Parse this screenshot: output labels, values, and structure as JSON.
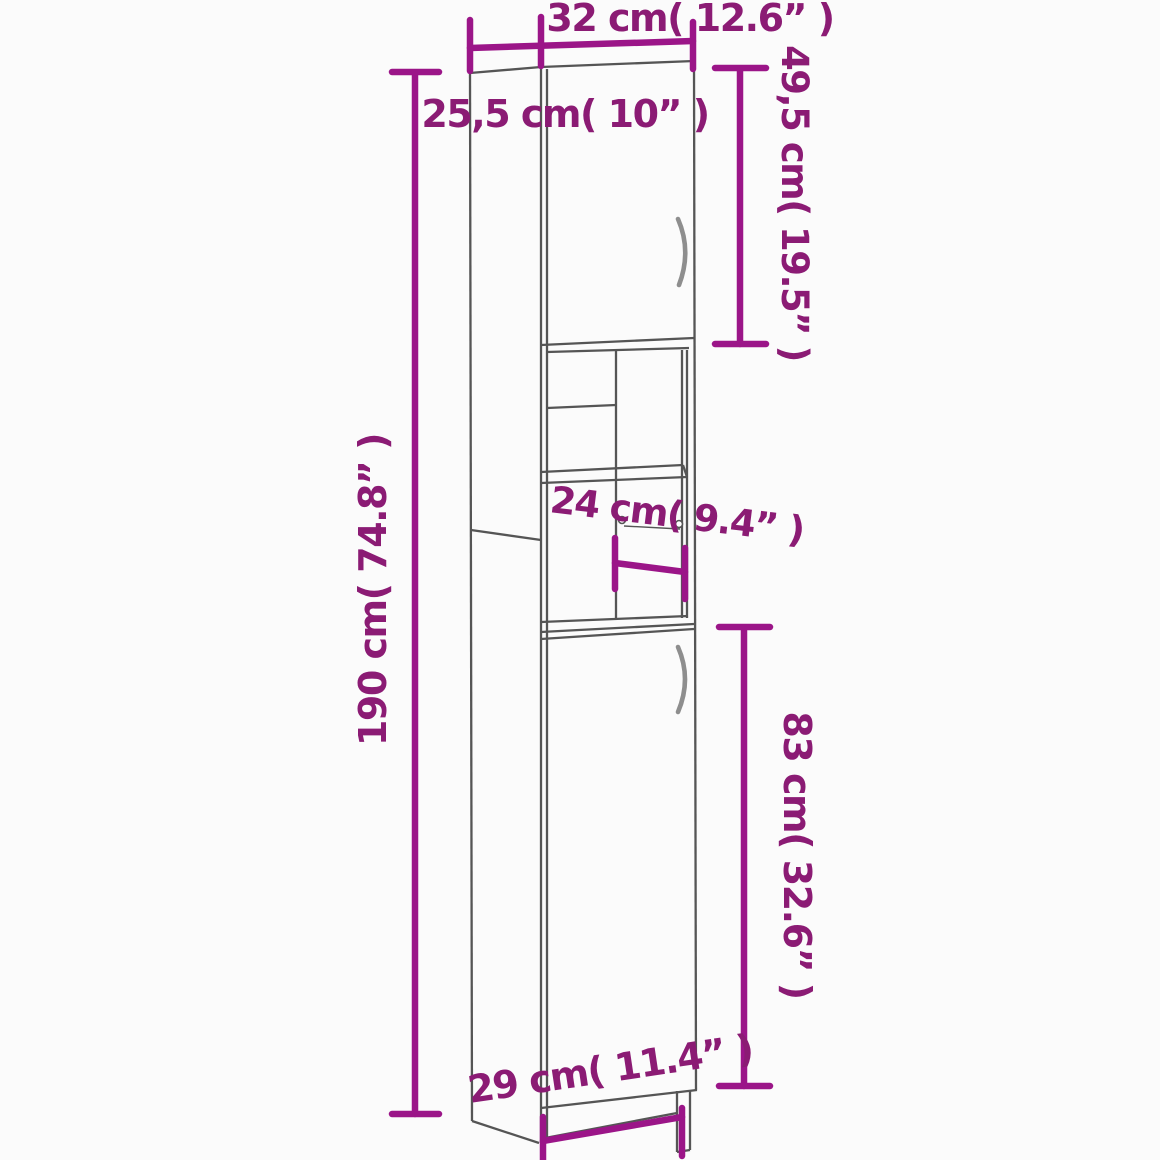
{
  "meta": {
    "type": "product-dimension-diagram",
    "subject": "tall narrow bathroom cabinet with two doors and open shelf niche"
  },
  "colors": {
    "dimension_line": "#9B1588",
    "dimension_text": "#8B1B74",
    "cabinet_outline": "#555555",
    "handle": "#8E8E8E",
    "background": "#FBFBFB"
  },
  "labels": {
    "width_top": "32 cm( 12.6” )",
    "depth_top": "25,5 cm( 10” )",
    "upper_door_height": "49,5 cm( 19.5” )",
    "shelf_depth": "24 cm( 9.4” )",
    "total_height": "190 cm( 74.8” )",
    "lower_door_height": "83 cm( 32.6” )",
    "width_bottom": "29 cm( 11.4” )"
  }
}
